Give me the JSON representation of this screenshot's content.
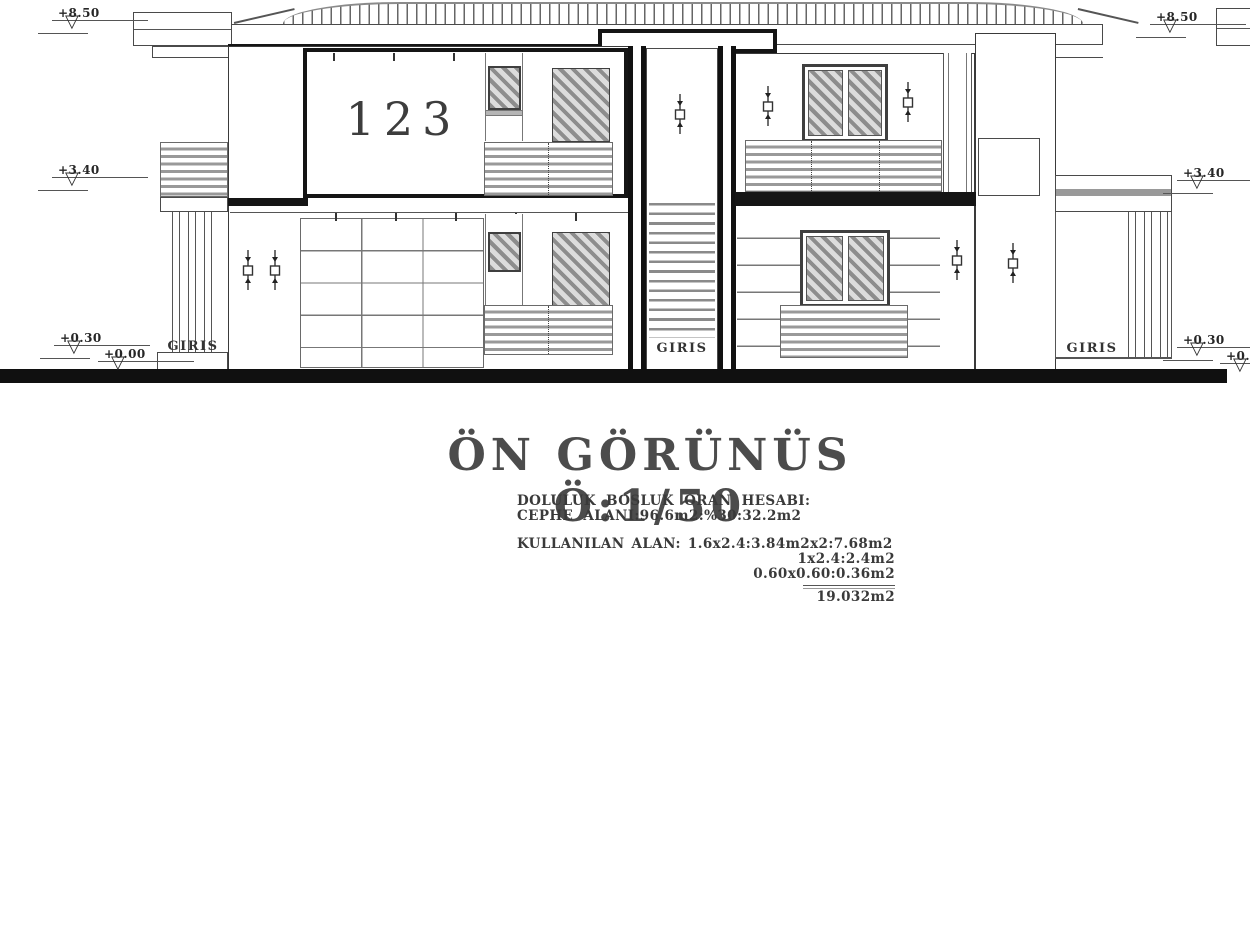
{
  "drawing": {
    "title": "ÖN GÖRÜNÜS Ö:1/50",
    "calc_block": {
      "heading": "DOLULUK BOSLUK ORAN HESABI:",
      "facade_area": "CEPHE ALANI:96.6m2:%30:32.2m2",
      "used_area_line1": "KULLANILAN ALAN: 1.6x2.4:3.84m2x2:7.68m2",
      "used_area_line2": "1x2.4:2.4m2",
      "used_area_line3": "0.60x0.60:0.36m2",
      "total": "19.032m2"
    },
    "labels": {
      "unit_number": "123",
      "entrance_left": "GIRIS",
      "entrance_center": "GIRIS",
      "entrance_right": "GIRIS"
    },
    "elevation_markers": {
      "left_top": "+8.50",
      "left_mid": "+3.40",
      "left_low": "+0.30",
      "left_ground": "+0.00",
      "right_top": "+8.50",
      "right_mid": "+3.40",
      "right_low": "+0.30",
      "right_ground": "+0.00"
    },
    "icons": {
      "benchmark_glyph": "▽"
    },
    "colors": {
      "line_dark": "#1a1a1a",
      "line_mid": "#555555",
      "hatch_gray": "#8d8d8d",
      "ground_black": "#101010",
      "background": "#ffffff"
    }
  }
}
